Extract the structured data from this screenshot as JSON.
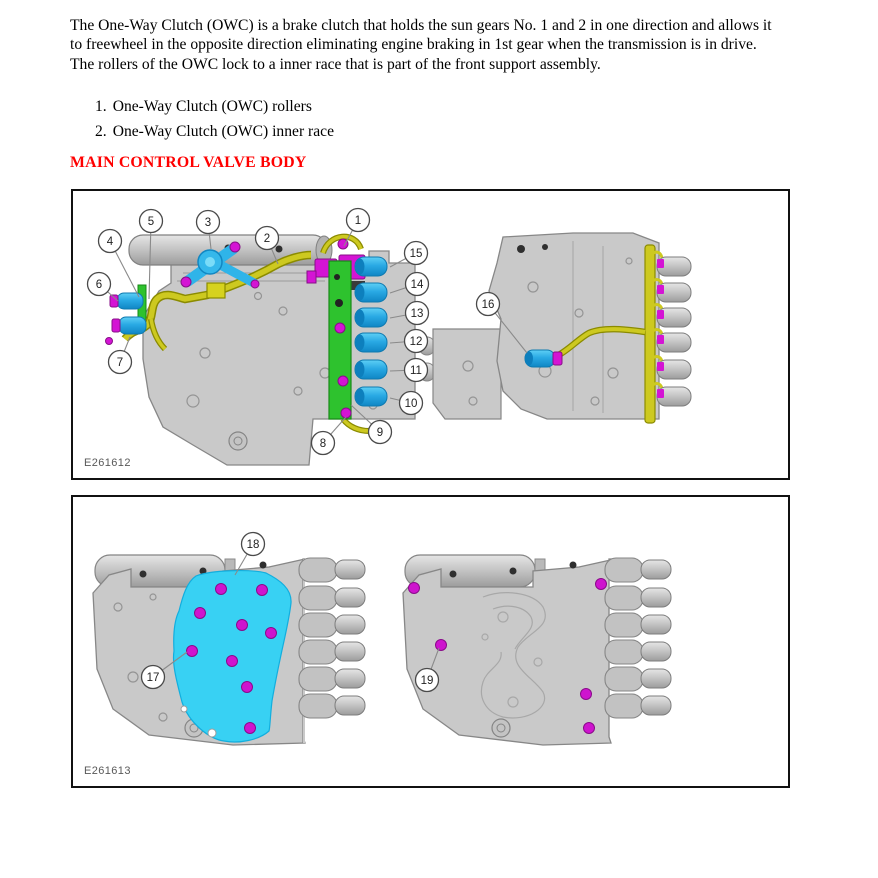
{
  "page": {
    "paragraph_lines": [
      "The One-Way Clutch (OWC) is a brake clutch that holds the sun gears No. 1 and 2 in one direction and allows it",
      "to freewheel in the opposite direction eliminating engine braking in 1st gear when the transmission is in drive.",
      "The rollers of the OWC lock to a inner race that is part of the front support assembly."
    ],
    "list": [
      {
        "num": "1.",
        "text": "One-Way Clutch (OWC) rollers"
      },
      {
        "num": "2.",
        "text": "One-Way Clutch (OWC) inner race"
      }
    ],
    "heading": "MAIN CONTROL VALVE BODY"
  },
  "colors": {
    "heading_red": "#ff0000",
    "solenoid_cyan": "#29a9e4",
    "harness_yellow": "#cdc920",
    "rail_green": "#2ec22e",
    "connector_magenta": "#d414d4",
    "body_gray": "#c9c9c9"
  },
  "figure1": {
    "label": "E261612",
    "callouts": [
      {
        "n": "1",
        "cx": 285,
        "cy": 29,
        "tx": 271,
        "ty": 55
      },
      {
        "n": "2",
        "cx": 194,
        "cy": 47,
        "tx": 205,
        "ty": 73
      },
      {
        "n": "3",
        "cx": 135,
        "cy": 31,
        "tx": 138,
        "ty": 58
      },
      {
        "n": "4",
        "cx": 37,
        "cy": 50,
        "tx": 66,
        "ty": 106
      },
      {
        "n": "5",
        "cx": 78,
        "cy": 30,
        "tx": 76,
        "ty": 108
      },
      {
        "n": "6",
        "cx": 26,
        "cy": 93,
        "tx": 45,
        "ty": 110
      },
      {
        "n": "7",
        "cx": 47,
        "cy": 171,
        "tx": 57,
        "ty": 146
      },
      {
        "n": "8",
        "cx": 250,
        "cy": 252,
        "tx": 273,
        "ty": 226
      },
      {
        "n": "9",
        "cx": 307,
        "cy": 241,
        "tx": 278,
        "ty": 214
      },
      {
        "n": "10",
        "cx": 338,
        "cy": 212,
        "tx": 317,
        "ty": 207
      },
      {
        "n": "11",
        "cx": 343,
        "cy": 179,
        "tx": 317,
        "ty": 180
      },
      {
        "n": "12",
        "cx": 343,
        "cy": 150,
        "tx": 317,
        "ty": 152
      },
      {
        "n": "13",
        "cx": 344,
        "cy": 122,
        "tx": 317,
        "ty": 127
      },
      {
        "n": "14",
        "cx": 344,
        "cy": 93,
        "tx": 317,
        "ty": 102
      },
      {
        "n": "15",
        "cx": 343,
        "cy": 62,
        "tx": 317,
        "ty": 76
      },
      {
        "n": "16",
        "cx": 415,
        "cy": 113,
        "tx": 454,
        "ty": 162
      }
    ]
  },
  "figure2": {
    "label": "E261613",
    "callouts": [
      {
        "n": "17",
        "cx": 80,
        "cy": 180,
        "tx": 114,
        "ty": 155
      },
      {
        "n": "18",
        "cx": 180,
        "cy": 47,
        "tx": 162,
        "ty": 78
      },
      {
        "n": "19",
        "cx": 354,
        "cy": 183,
        "tx": 366,
        "ty": 151
      }
    ]
  }
}
